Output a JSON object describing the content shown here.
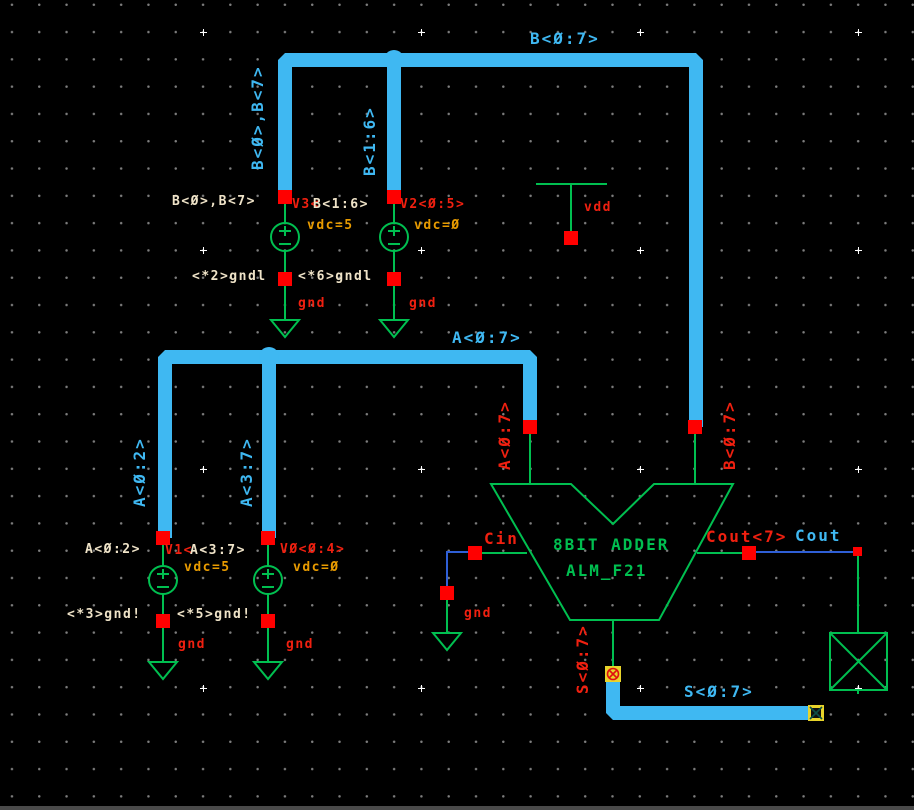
{
  "colors": {
    "bus_blue": "#3fb8f2",
    "wire_blue": "#2f5fd6",
    "symbol_green": "#00bf50",
    "pin_red": "#ff0000",
    "text_red": "#f02010",
    "text_white": "#efe3c8",
    "text_orange": "#e89b00",
    "marker_yellow": "#e8d42a",
    "background": "#000000"
  },
  "nets": {
    "b_bus": "B<Ø:7>",
    "b_left": "B<Ø>,B<7>",
    "b_mid": "B<1:6>",
    "a_bus": "A<Ø:7>",
    "a_left": "A<Ø:2>",
    "a_mid": "A<3:7>",
    "s_bus": "S<Ø:7>",
    "cout": "Cout"
  },
  "sources": [
    {
      "name": "V3<",
      "value": "vdc=5",
      "net": "B<Ø>,B<7>",
      "ref": "<*2>gndl"
    },
    {
      "name": "V2<Ø:5>",
      "value": "vdc=Ø",
      "net": "B<1:6>",
      "ref": "<*6>gndl"
    },
    {
      "name": "V1<",
      "value": "vdc=5",
      "net": "A<Ø:2>",
      "ref": "<*3>gnd!"
    },
    {
      "name": "VØ<Ø:4>",
      "value": "vdc=Ø",
      "net": "A<3:7>",
      "ref": "<*5>gnd!"
    }
  ],
  "adder": {
    "title": "8BIT ADDER",
    "subtitle": "ALM_F21",
    "pin_a": "A<Ø:7>",
    "pin_b": "B<Ø:7>",
    "pin_cin": "Cin",
    "pin_cout": "Cout<7>",
    "pin_s": "S<Ø:7>"
  },
  "symbols": {
    "gnd": "gnd",
    "vdd": "vdd"
  }
}
